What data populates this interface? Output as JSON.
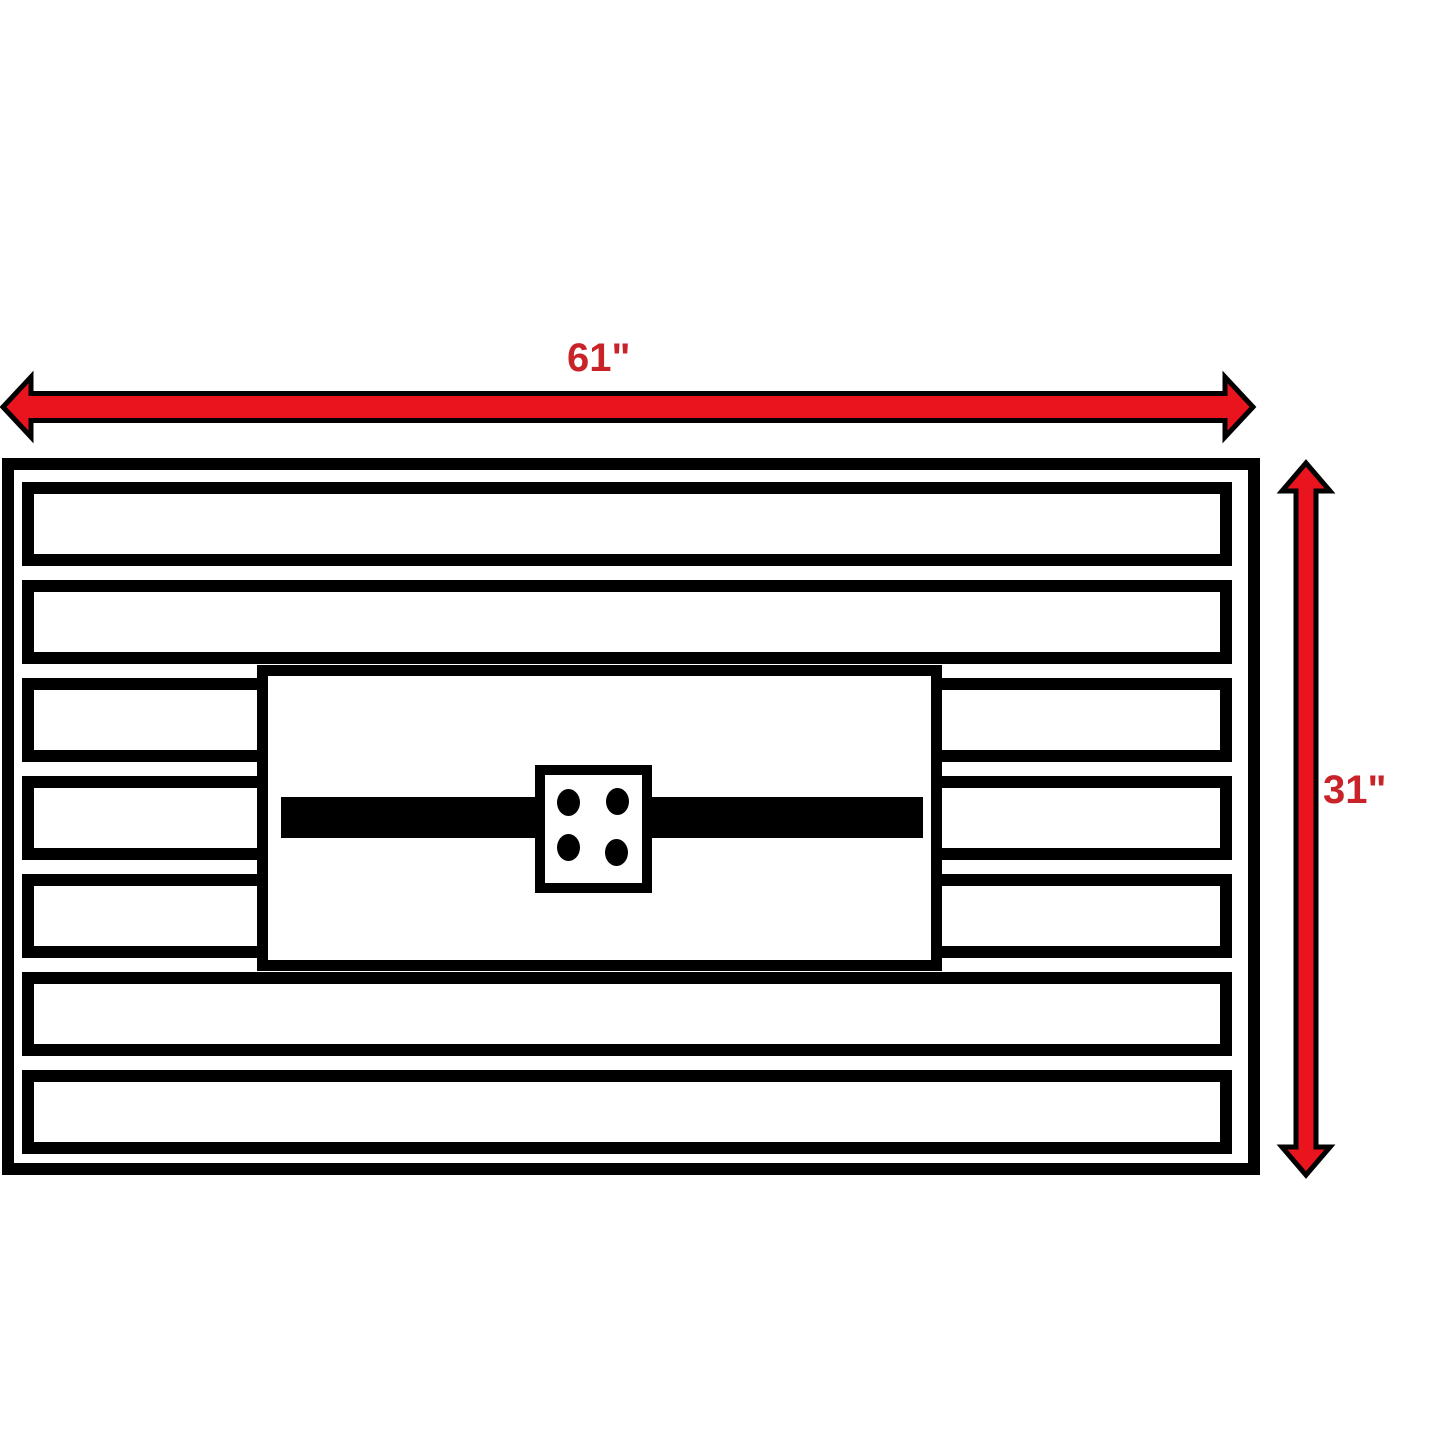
{
  "diagram": {
    "type": "dimension-drawing",
    "subject": "slatted rectangular table top with center burner panel",
    "width_label": "61\"",
    "height_label": "31\"",
    "slat_count": 7,
    "bolt_hole_count": 4,
    "colors": {
      "arrow": "#e9141d",
      "label": "#c9232a",
      "outline": "#000000",
      "surface": "#ffffff"
    }
  }
}
